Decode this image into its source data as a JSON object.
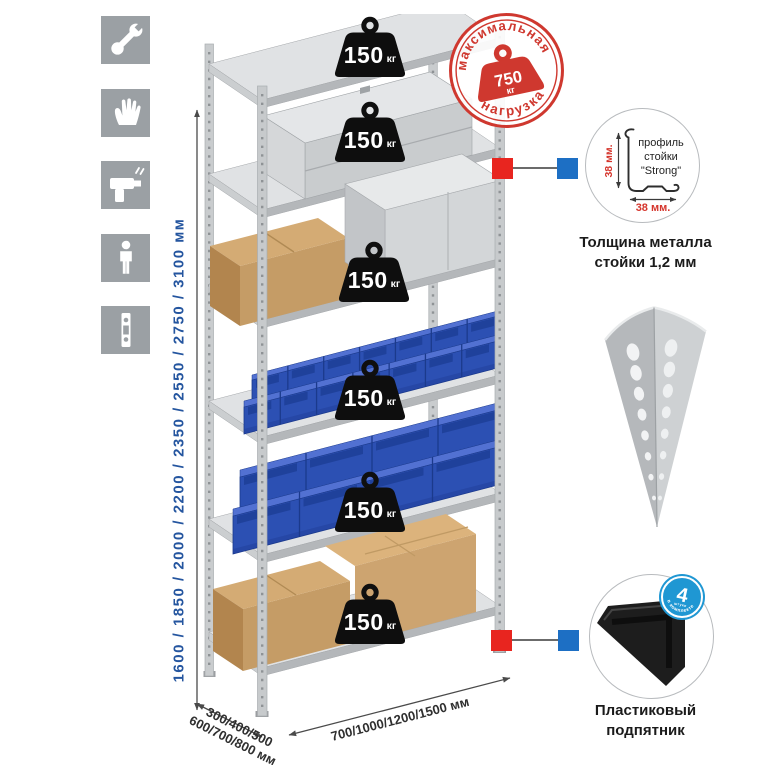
{
  "sidebar": {
    "icons": [
      "wrench-icon",
      "gloves-icon",
      "drill-icon",
      "person-height-icon",
      "perforated-profile-icon"
    ]
  },
  "dimensions": {
    "height_options": "1600 / 1850 / 2000 / 2200 / 2350 / 2550 / 2750 / 3100 мм",
    "depth_options_line1": "300/400/500",
    "depth_options_line2": "600/700/800 мм",
    "width_options": "700/1000/1200/1500 мм"
  },
  "shelves": [
    {
      "load_value": "150",
      "load_unit": "кг"
    },
    {
      "load_value": "150",
      "load_unit": "кг"
    },
    {
      "load_value": "150",
      "load_unit": "кг"
    },
    {
      "load_value": "150",
      "load_unit": "кг"
    },
    {
      "load_value": "150",
      "load_unit": "кг"
    },
    {
      "load_value": "150",
      "load_unit": "кг"
    }
  ],
  "max_load_stamp": {
    "arc_top": "максимальная",
    "arc_bottom": "нагрузка",
    "value": "750",
    "unit": "кг"
  },
  "profile_detail": {
    "label_line1": "профиль",
    "label_line2": "стойки",
    "label_line3": "\"Strong\"",
    "dim_vertical": "38 мм.",
    "dim_horizontal": "38 мм.",
    "caption_line1": "Толщина металла",
    "caption_line2": "стойки 1,2 мм"
  },
  "foot_detail": {
    "badge_value": "4",
    "badge_sub": "штуки",
    "badge_arc": "в комплекте",
    "caption_line1": "Пластиковый",
    "caption_line2": "подпятник"
  },
  "colors": {
    "stamp_red": "#cf382f",
    "marker_red": "#e8251f",
    "marker_blue": "#1d6fc4",
    "dimension_blue": "#24559f",
    "bin_blue": "#2c50b3",
    "icon_gray": "#9ba0a4",
    "kit_badge_blue": "#1f97d3"
  }
}
